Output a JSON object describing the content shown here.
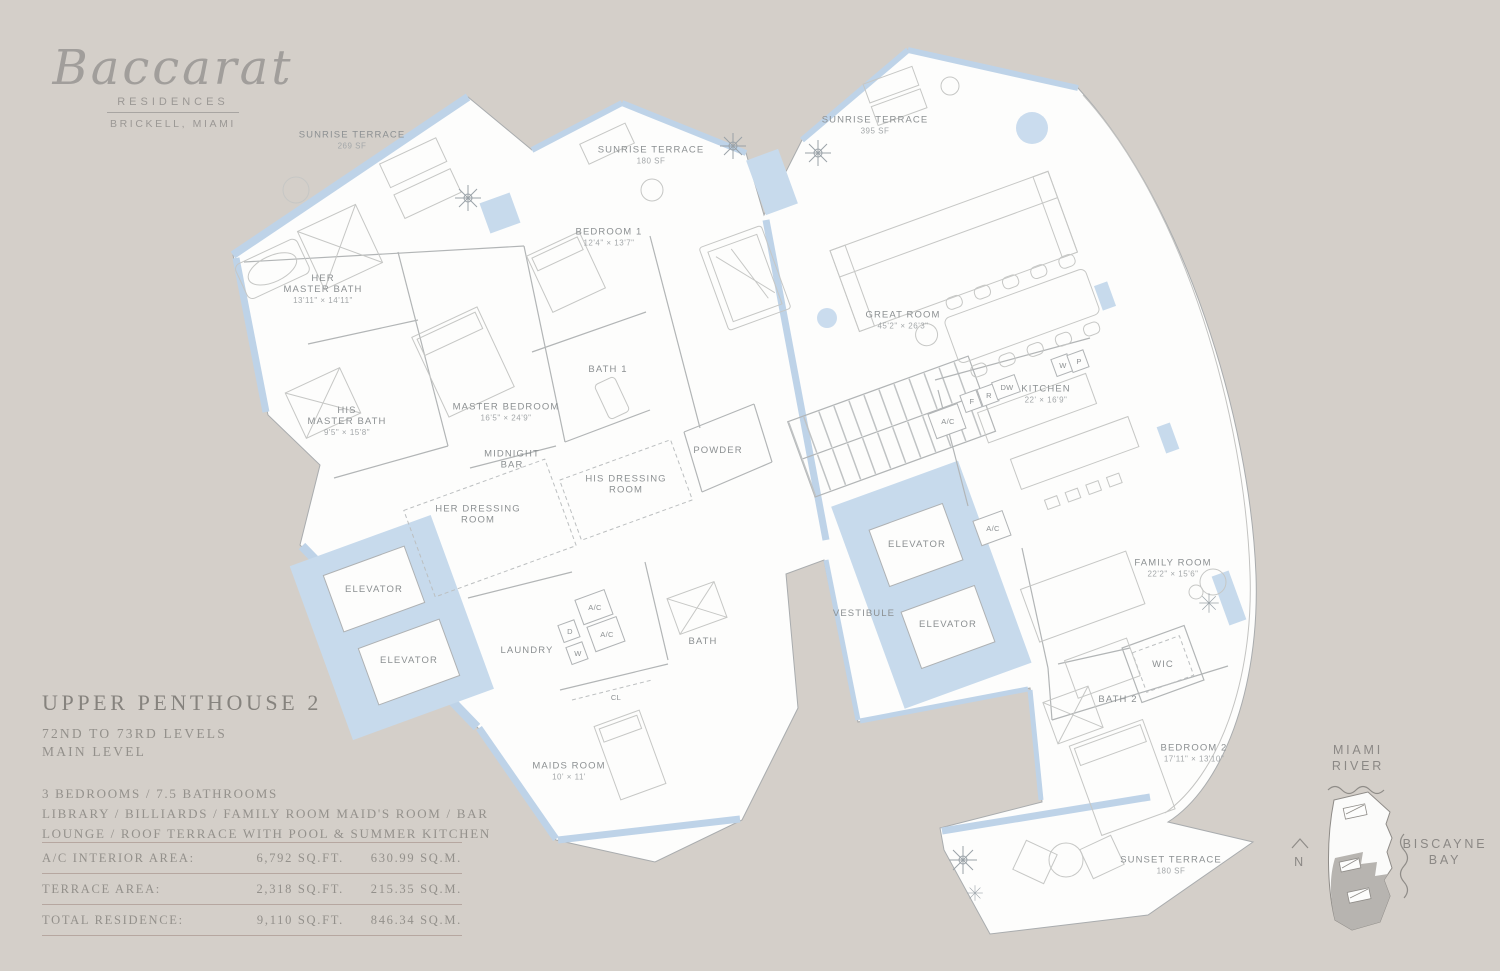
{
  "colors": {
    "background": "#d4cfc9",
    "plan_fill": "#fdfdfc",
    "accent_blue": "#c7daec",
    "band_blue": "#bed3e8",
    "line_gray": "#b2b5b6",
    "label_gray": "#8c9092",
    "text_gray": "#8e8a85",
    "rule_pink": "#b6a7a0"
  },
  "brand": {
    "name": "Baccarat",
    "type": "RESIDENCES",
    "location": "BRICKELL, MIAMI"
  },
  "unit": {
    "title": "UPPER PENTHOUSE 2",
    "levels": "72ND TO 73RD LEVELS",
    "level": "MAIN LEVEL",
    "features": "3 BEDROOMS / 7.5 BATHROOMS\nLIBRARY / BILLIARDS / FAMILY ROOM  MAID'S ROOM / BAR\nLOUNGE / ROOF TERRACE WITH POOL & SUMMER KITCHEN"
  },
  "areas": {
    "rows": [
      {
        "label": "A/C INTERIOR AREA:",
        "sqft": "6,792 SQ.FT.",
        "sqm": "630.99 SQ.M."
      },
      {
        "label": "TERRACE AREA:",
        "sqft": "2,318 SQ.FT.",
        "sqm": "215.35 SQ.M."
      },
      {
        "label": "TOTAL RESIDENCE:",
        "sqft": "9,110 SQ.FT.",
        "sqm": "846.34 SQ.M."
      }
    ]
  },
  "floorplan": {
    "rooms": [
      {
        "lines": [
          "SUNRISE TERRACE"
        ],
        "dims": "269 SF",
        "x": 352,
        "y": 143
      },
      {
        "lines": [
          "SUNRISE TERRACE"
        ],
        "dims": "180 SF",
        "x": 651,
        "y": 158
      },
      {
        "lines": [
          "SUNRISE TERRACE"
        ],
        "dims": "395 SF",
        "x": 875,
        "y": 128
      },
      {
        "lines": [
          "BEDROOM 1"
        ],
        "dims": "12'4\" × 13'7\"",
        "x": 609,
        "y": 240
      },
      {
        "lines": [
          "HER",
          "MASTER BATH"
        ],
        "dims": "13'11\" × 14'11\"",
        "x": 323,
        "y": 292
      },
      {
        "lines": [
          "HIS",
          "MASTER BATH"
        ],
        "dims": "9'5\" × 15'8\"",
        "x": 347,
        "y": 424
      },
      {
        "lines": [
          "MASTER BEDROOM"
        ],
        "dims": "16'5\" × 24'9\"",
        "x": 506,
        "y": 415
      },
      {
        "lines": [
          "BATH 1"
        ],
        "dims": "",
        "x": 608,
        "y": 372
      },
      {
        "lines": [
          "GREAT ROOM"
        ],
        "dims": "45'2\" × 26'3\"",
        "x": 903,
        "y": 323
      },
      {
        "lines": [
          "KITCHEN"
        ],
        "dims": "22' × 16'9\"",
        "x": 1046,
        "y": 397
      },
      {
        "lines": [
          "MIDNIGHT",
          "BAR"
        ],
        "dims": "",
        "x": 512,
        "y": 462
      },
      {
        "lines": [
          "HIS DRESSING",
          "ROOM"
        ],
        "dims": "",
        "x": 626,
        "y": 487
      },
      {
        "lines": [
          "HER DRESSING",
          "ROOM"
        ],
        "dims": "",
        "x": 478,
        "y": 517
      },
      {
        "lines": [
          "POWDER"
        ],
        "dims": "",
        "x": 718,
        "y": 453
      },
      {
        "lines": [
          "ELEVATOR"
        ],
        "dims": "",
        "x": 374,
        "y": 592
      },
      {
        "lines": [
          "ELEVATOR"
        ],
        "dims": "",
        "x": 409,
        "y": 663
      },
      {
        "lines": [
          "ELEVATOR"
        ],
        "dims": "",
        "x": 917,
        "y": 547
      },
      {
        "lines": [
          "ELEVATOR"
        ],
        "dims": "",
        "x": 948,
        "y": 627
      },
      {
        "lines": [
          "VESTIBULE"
        ],
        "dims": "",
        "x": 864,
        "y": 616
      },
      {
        "lines": [
          "LAUNDRY"
        ],
        "dims": "",
        "x": 527,
        "y": 653
      },
      {
        "lines": [
          "BATH"
        ],
        "dims": "",
        "x": 703,
        "y": 644
      },
      {
        "lines": [
          "MAIDS ROOM"
        ],
        "dims": "10' × 11'",
        "x": 569,
        "y": 774
      },
      {
        "lines": [
          "FAMILY ROOM"
        ],
        "dims": "22'2\" × 15'6\"",
        "x": 1173,
        "y": 571
      },
      {
        "lines": [
          "WIC"
        ],
        "dims": "",
        "x": 1163,
        "y": 667
      },
      {
        "lines": [
          "BATH 2"
        ],
        "dims": "",
        "x": 1118,
        "y": 702
      },
      {
        "lines": [
          "BEDROOM 2"
        ],
        "dims": "17'11\" × 13'10\"",
        "x": 1194,
        "y": 756
      },
      {
        "lines": [
          "SUNSET TERRACE"
        ],
        "dims": "180 SF",
        "x": 1171,
        "y": 868
      }
    ],
    "small_labels": [
      {
        "t": "A/C",
        "x": 948,
        "y": 424,
        "box": true
      },
      {
        "t": "A/C",
        "x": 993,
        "y": 531,
        "box": true
      },
      {
        "t": "A/C",
        "x": 595,
        "y": 610,
        "box": true
      },
      {
        "t": "A/C",
        "x": 607,
        "y": 637,
        "box": true
      },
      {
        "t": "D",
        "x": 570,
        "y": 634,
        "box": true
      },
      {
        "t": "W",
        "x": 578,
        "y": 656,
        "box": true
      },
      {
        "t": "F",
        "x": 972,
        "y": 404,
        "box": true
      },
      {
        "t": "R",
        "x": 989,
        "y": 398,
        "box": true
      },
      {
        "t": "DW",
        "x": 1007,
        "y": 390,
        "box": true
      },
      {
        "t": "W",
        "x": 1063,
        "y": 368,
        "box": true
      },
      {
        "t": "P",
        "x": 1079,
        "y": 364,
        "box": true
      },
      {
        "t": "CL",
        "x": 616,
        "y": 700,
        "box": false
      }
    ]
  },
  "keyplan": {
    "north": "N",
    "labels": [
      {
        "lines": [
          "MIAMI",
          "RIVER"
        ],
        "x": 1358,
        "y": 762
      },
      {
        "lines": [
          "BISCAYNE",
          "BAY"
        ],
        "x": 1445,
        "y": 856
      },
      {
        "lines": [
          "N"
        ],
        "x": 1300,
        "y": 866
      }
    ]
  }
}
